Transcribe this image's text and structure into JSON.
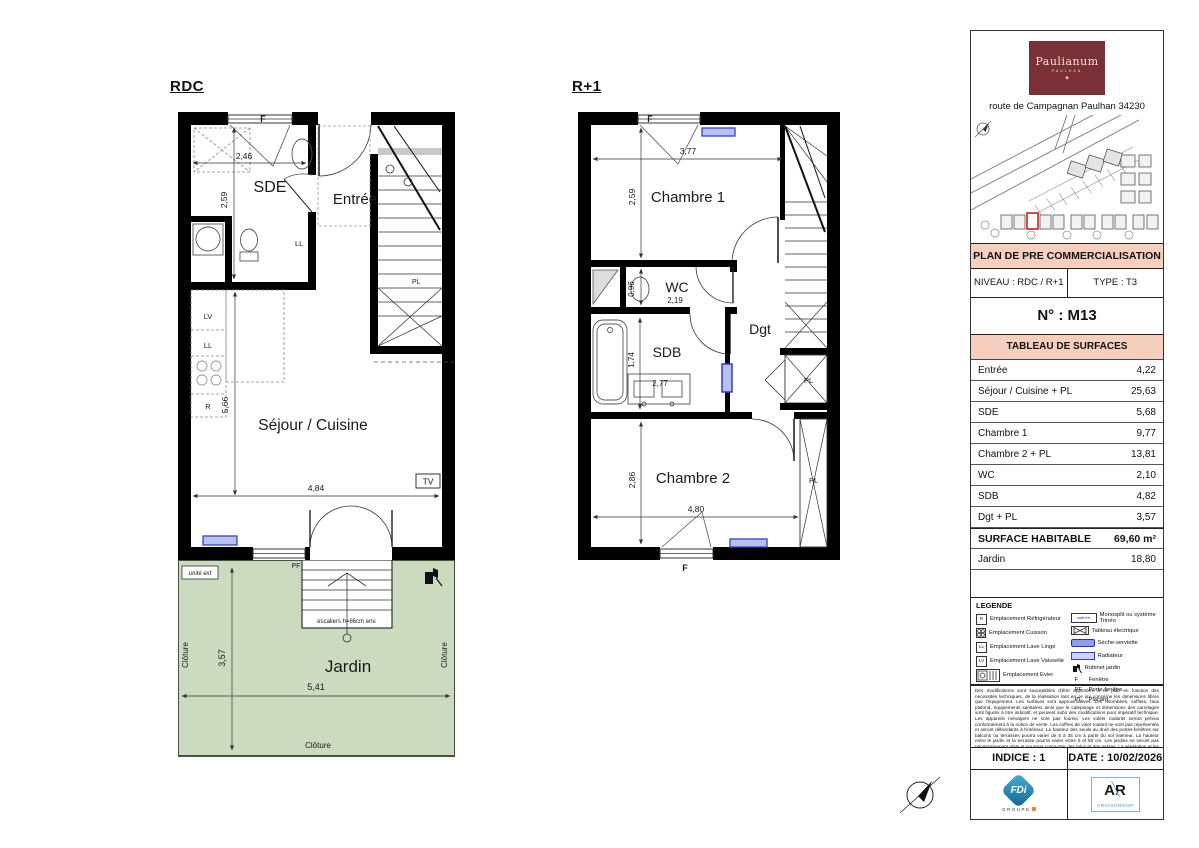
{
  "document": {
    "rdc": {
      "title": "RDC",
      "rooms": {
        "sde": "SDE",
        "entree": "Entrée",
        "sejour_cuisine": "Séjour / Cuisine"
      },
      "dims": {
        "w_sde": "2,46",
        "h_sde": "2,59",
        "h_sejour": "5,66",
        "w_sejour": "4,84"
      },
      "tags": {
        "f_top": "F",
        "ll_sde": "LL",
        "lv": "LV",
        "ll_kit": "LL",
        "r": "R",
        "tv": "TV",
        "pl_stairs": "PL"
      }
    },
    "jardin": {
      "name": "Jardin",
      "stairs_note": "escaliers h=86cm env.",
      "unite": "unité ext",
      "cloture": "Clôture",
      "dims": {
        "h": "3,57",
        "w": "5,41"
      },
      "tags": {
        "pf": "PF"
      }
    },
    "r1": {
      "title": "R+1",
      "rooms": {
        "ch1": "Chambre 1",
        "wc": "WC",
        "sdb": "SDB",
        "dgt": "Dgt",
        "ch2": "Chambre 2"
      },
      "dims": {
        "w_ch1": "3,77",
        "h_ch1": "2,59",
        "w_wc": "2,19",
        "h_wc": "0,96",
        "h_sdb": "1,74",
        "w_sdb": "2,77",
        "h_ch2": "2,86",
        "w_ch2": "4,80"
      },
      "tags": {
        "f_top": "F",
        "f_bottom": "F",
        "pl_dgt": "PL",
        "pl_ch2": "PL"
      }
    }
  },
  "sidebar": {
    "logo": {
      "brand": "Paulianum",
      "sub": "PAULHAN"
    },
    "address": "route de Campagnan Paulhan 34230",
    "banner": "PLAN DE PRE COMMERCIALISATION",
    "niveau": "NIVEAU : RDC / R+1",
    "type": "TYPE :  T3",
    "numero": "N° : M13",
    "table_header": "TABLEAU DE SURFACES",
    "surfaces": [
      {
        "label": "Entrée",
        "value": "4,22"
      },
      {
        "label": "Séjour / Cuisine + PL",
        "value": "25,63"
      },
      {
        "label": "SDE",
        "value": "5,68"
      },
      {
        "label": "Chambre 1",
        "value": "9,77"
      },
      {
        "label": "Chambre 2 + PL",
        "value": "13,81"
      },
      {
        "label": "WC",
        "value": "2,10"
      },
      {
        "label": "SDB",
        "value": "4,82"
      },
      {
        "label": "Dgt + PL",
        "value": "3,57"
      }
    ],
    "total": {
      "label": "SURFACE HABITABLE",
      "value": "69,60 m²"
    },
    "jardin_row": {
      "label": "Jardin",
      "value": "18,80"
    },
    "legend": {
      "title": "LEGENDE",
      "left": [
        "Emplacement Réfrigérateur",
        "Emplacement Cuisson",
        "Emplacement Lave Linge",
        "Emplacement Lave Vaisselle",
        "Emplacement Evier"
      ],
      "right": [
        "Monosplit ou système Trinéo",
        "Tableau électrique",
        "Sèche-serviette",
        "Radiateur",
        "Robinet jardin"
      ],
      "keys": {
        "r": "R",
        "ll": "LL",
        "lv": "LV"
      },
      "monosplit_text": "unité ext",
      "abbr": [
        {
          "k": "F",
          "v": "Fenêtre"
        },
        {
          "k": "PF",
          "v": "Porte-fenêtre"
        },
        {
          "k": "PL",
          "v": "Placard"
        }
      ]
    },
    "disclaimer": "Des modifications sont susceptibles d'être apportées à ce plan en fonction des nécessités techniques, de la réalisation tant en ce qui concerne les dimensions libres que l'équipement. Les surfaces sont approximatives. Les retombées, soffites, faux plafond, équipements sanitaires ainsi que le calepinage et dimensions des carrelages sont figurés à titre indicatif, et peuvent subir des modifications pour impératif technique. Les appareils ménagers ne sont pas fournis. Les volets roulants seront prévus conformément à la notice de vente. Les coffres de volet roulant ne sont pas représentés et seront débordants à l'intérieur. La hauteur des seuils au droit des portes-fenêtres sur balcons ou terrasses pourra varier de 5 à 35 cm à partir du sol intérieur. La hauteur entre le jardin et la terrasse pourra varier entre 0 et 60 cm. Les jardins ne seront pas nécessairement plats et pourront comporter des talus et des pentes. La végétation et les arbres ne sont pas représentés sur ce plan.",
    "indice": "INDICE : 1",
    "date": "DATE : 10/02/2026",
    "logos": {
      "fdi": "FDi",
      "fdi_sub": "GROUPE",
      "ar": "AR",
      "archigroup": "ARCHIGROUP"
    }
  }
}
